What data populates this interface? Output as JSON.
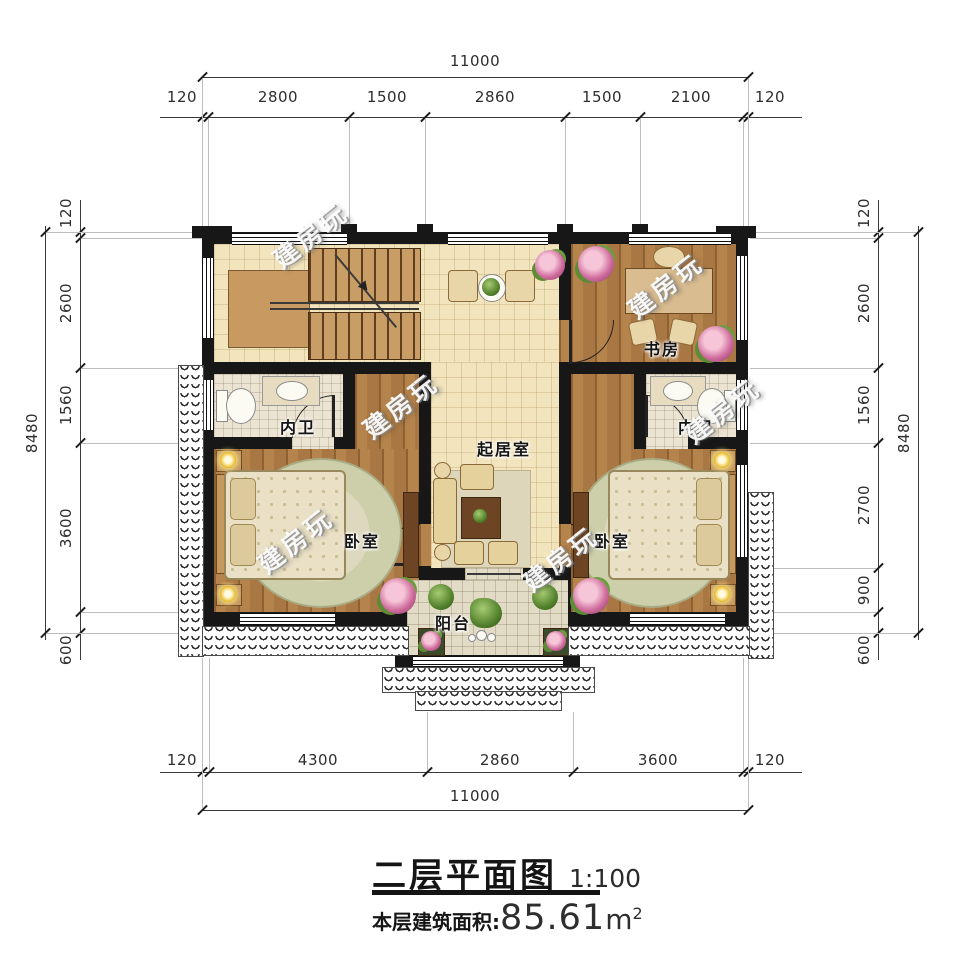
{
  "watermark": {
    "text": "建房玩"
  },
  "dims": {
    "top": {
      "total": "11000",
      "segments": [
        "120",
        "2800",
        "1500",
        "2860",
        "1500",
        "2100",
        "120"
      ]
    },
    "bottom": {
      "total": "11000",
      "segments": [
        "120",
        "4300",
        "2860",
        "3600",
        "120"
      ]
    },
    "left": {
      "total": "8480",
      "segments": [
        "120",
        "2600",
        "1560",
        "3600",
        "600"
      ]
    },
    "right": {
      "total": "8480",
      "segments": [
        "120",
        "2600",
        "1560",
        "2700",
        "900",
        "600"
      ]
    }
  },
  "rooms": {
    "study": {
      "label": "书房"
    },
    "bath_left": {
      "label": "内卫"
    },
    "bath_right": {
      "label": "内卫"
    },
    "living": {
      "label": "起居室"
    },
    "bedroom_left": {
      "label": "卧室"
    },
    "bedroom_right": {
      "label": "卧室"
    },
    "balcony": {
      "label": "阳台"
    }
  },
  "title": {
    "name": "二层平面图",
    "scale": "1:100",
    "area_label": "本层建筑面积:",
    "area_value": "85.61",
    "area_unit": "m",
    "area_sup": "2"
  },
  "palette": {
    "wall": "#171717",
    "tile_floor": "#f2e4bd",
    "wood_floor": "#a87743",
    "bath_floor": "#ece4d2",
    "paper": "#ffffff"
  }
}
